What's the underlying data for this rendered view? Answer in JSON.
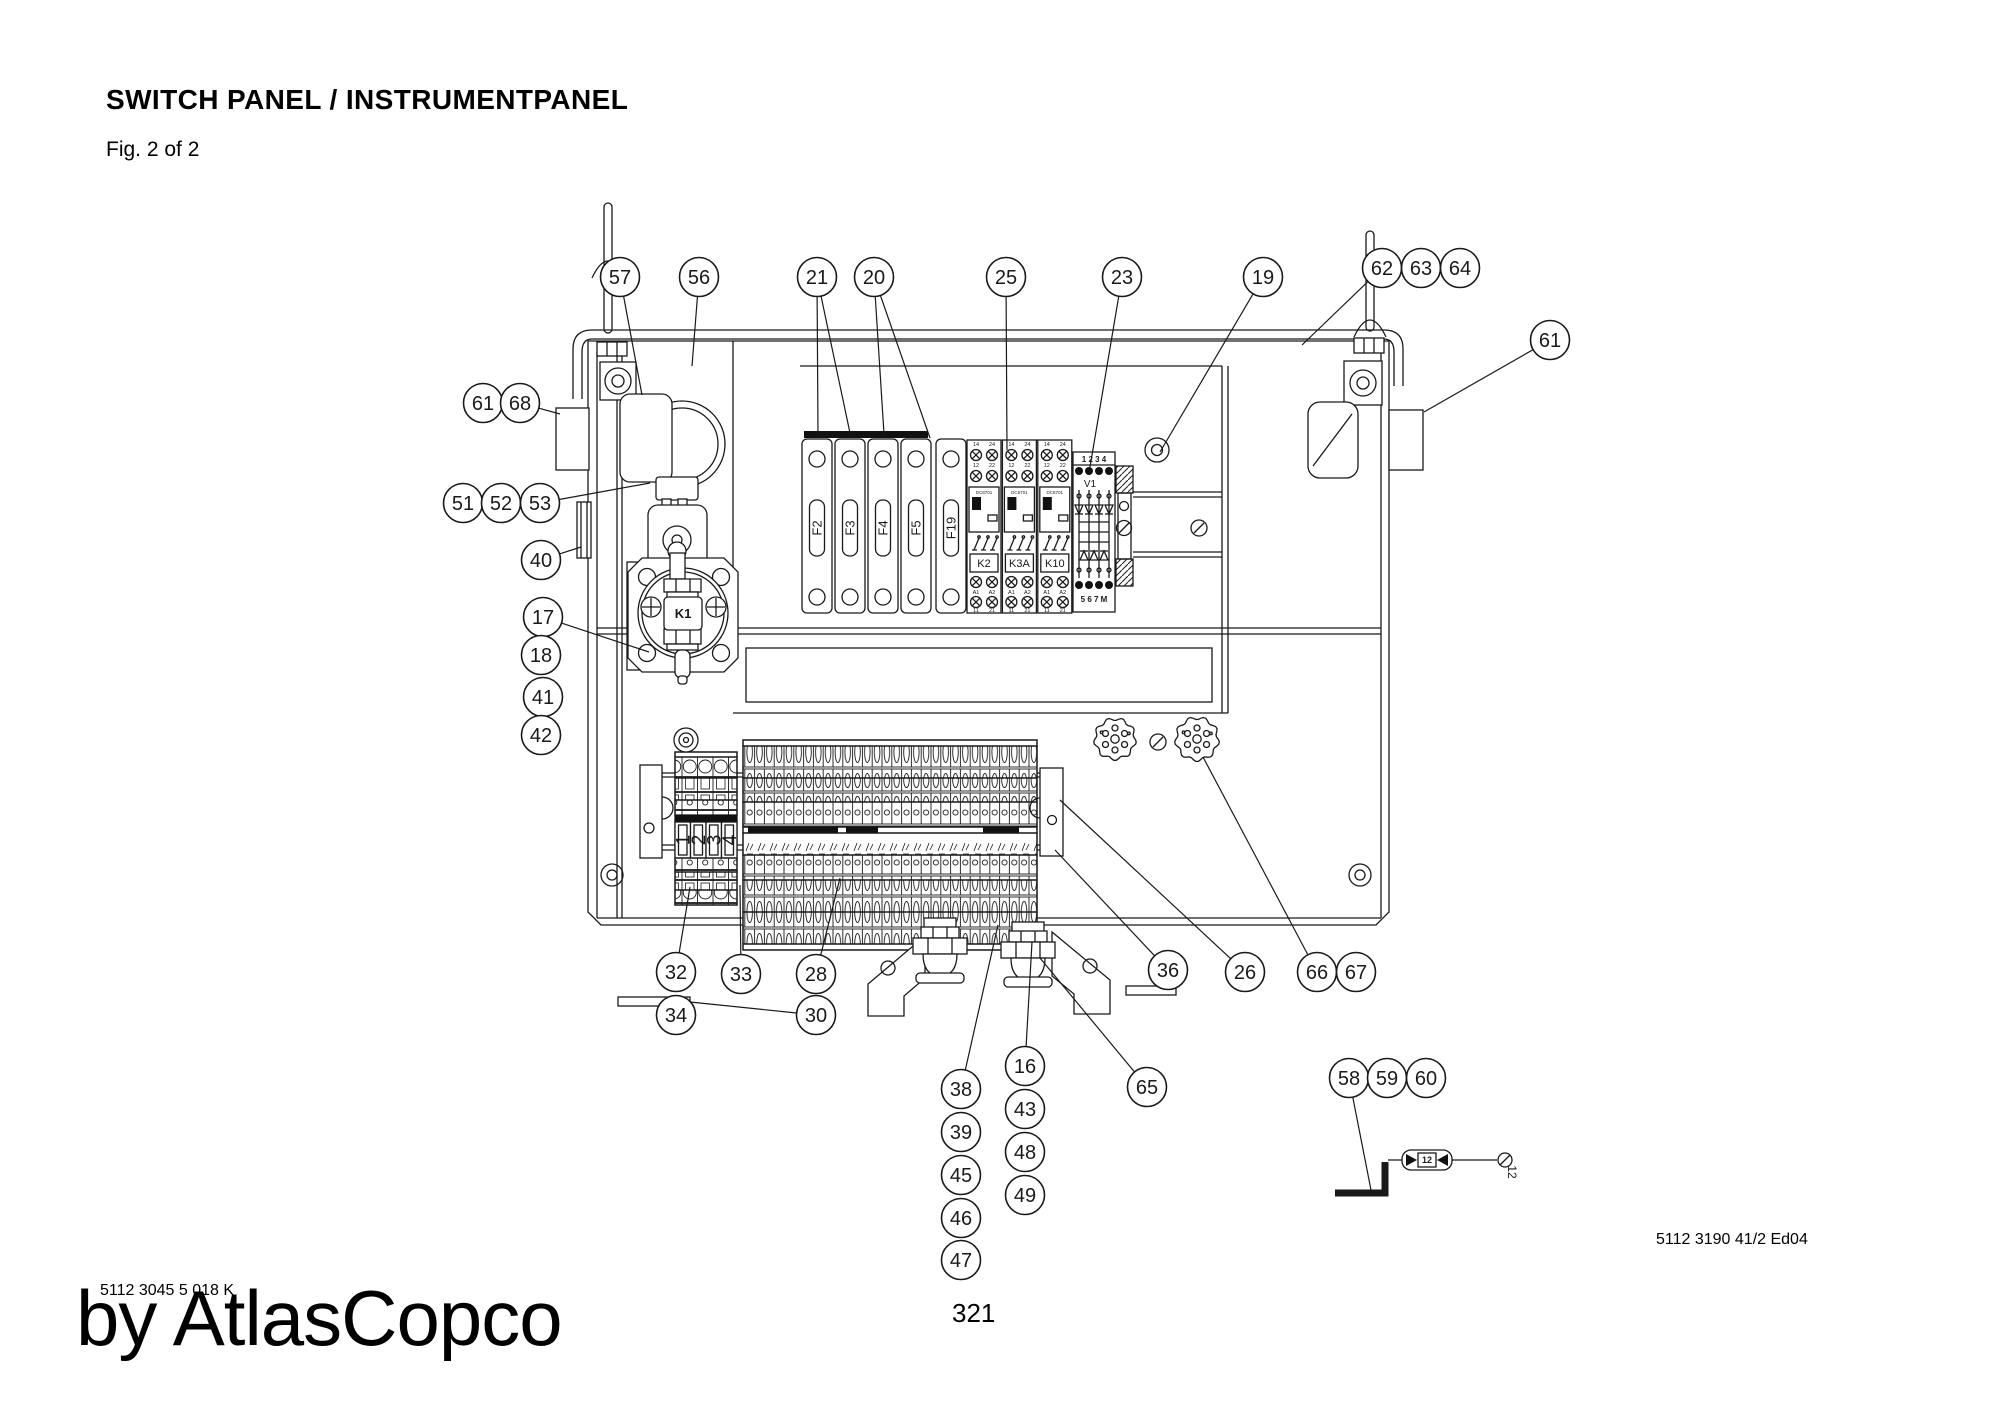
{
  "header": {
    "title": "SWITCH PANEL / INSTRUMENTPANEL",
    "figure": "Fig. 2 of 2"
  },
  "footer": {
    "page_number": "321",
    "doc_number_left": "5112 3045 5 018 K",
    "doc_number_right": "5112 3190 41/2 Ed04",
    "watermark": "by AtlasCopco"
  },
  "drawing": {
    "fuses": [
      "F2",
      "F3",
      "F4",
      "F5",
      "F19"
    ],
    "relays": [
      "K2",
      "K3A",
      "K10"
    ],
    "relay_code": "DC8701",
    "relay_terminals": {
      "row1": [
        "14",
        "24"
      ],
      "row2": [
        "12",
        "22"
      ],
      "row3": [
        "A1",
        "A2"
      ],
      "row4": [
        "11",
        "21"
      ]
    },
    "v1": {
      "label": "V1",
      "top": "1 2 3 4",
      "bottom": "5 6 7 M"
    },
    "k1_label": "K1",
    "terminal_block_numbers": [
      "1",
      "2",
      "3",
      "4"
    ],
    "inline_fuse": {
      "label": "12",
      "wire_ref": "12"
    }
  },
  "callouts": [
    {
      "n": "57",
      "x": 620,
      "y": 277,
      "to": [
        [
          642,
          395
        ]
      ]
    },
    {
      "n": "56",
      "x": 699,
      "y": 277,
      "to": [
        [
          692,
          366
        ]
      ]
    },
    {
      "n": "21",
      "x": 817,
      "y": 277,
      "to": [
        [
          818,
          433
        ],
        [
          850,
          433
        ]
      ]
    },
    {
      "n": "20",
      "x": 874,
      "y": 277,
      "to": [
        [
          884,
          434
        ],
        [
          930,
          438
        ]
      ]
    },
    {
      "n": "25",
      "x": 1006,
      "y": 277,
      "to": [
        [
          1007,
          450
        ]
      ]
    },
    {
      "n": "23",
      "x": 1122,
      "y": 277,
      "to": [
        [
          1090,
          467
        ]
      ]
    },
    {
      "n": "19",
      "x": 1263,
      "y": 277,
      "to": [
        [
          1160,
          452
        ]
      ]
    },
    {
      "n": "62",
      "x": 1382,
      "y": 268,
      "to": [
        [
          1302,
          345
        ]
      ]
    },
    {
      "n": "63",
      "x": 1421,
      "y": 268,
      "to": []
    },
    {
      "n": "64",
      "x": 1460,
      "y": 268,
      "to": []
    },
    {
      "n": "61",
      "x": 1550,
      "y": 340,
      "to": [
        [
          1424,
          412
        ]
      ]
    },
    {
      "n": "61",
      "x": 483,
      "y": 403,
      "to": []
    },
    {
      "n": "68",
      "x": 520,
      "y": 403,
      "to": [
        [
          560,
          414
        ]
      ]
    },
    {
      "n": "51",
      "x": 463,
      "y": 503,
      "to": []
    },
    {
      "n": "52",
      "x": 501,
      "y": 503,
      "to": []
    },
    {
      "n": "53",
      "x": 540,
      "y": 503,
      "to": [
        [
          650,
          483
        ]
      ]
    },
    {
      "n": "40",
      "x": 541,
      "y": 560,
      "to": [
        [
          581,
          547
        ]
      ]
    },
    {
      "n": "17",
      "x": 543,
      "y": 617,
      "to": [
        [
          649,
          652
        ]
      ]
    },
    {
      "n": "18",
      "x": 541,
      "y": 655,
      "to": []
    },
    {
      "n": "41",
      "x": 543,
      "y": 697,
      "to": []
    },
    {
      "n": "42",
      "x": 541,
      "y": 735,
      "to": []
    },
    {
      "n": "32",
      "x": 676,
      "y": 972,
      "to": [
        [
          690,
          887
        ]
      ]
    },
    {
      "n": "34",
      "x": 676,
      "y": 1015,
      "to": []
    },
    {
      "n": "33",
      "x": 741,
      "y": 974,
      "to": [
        [
          740,
          885
        ]
      ]
    },
    {
      "n": "28",
      "x": 816,
      "y": 974,
      "to": [
        [
          840,
          878
        ]
      ]
    },
    {
      "n": "30",
      "x": 816,
      "y": 1015,
      "to": [
        [
          690,
          1002
        ]
      ]
    },
    {
      "n": "36",
      "x": 1168,
      "y": 970,
      "to": [
        [
          1055,
          850
        ]
      ]
    },
    {
      "n": "26",
      "x": 1245,
      "y": 972,
      "to": [
        [
          1060,
          800
        ]
      ]
    },
    {
      "n": "66",
      "x": 1317,
      "y": 972,
      "to": [
        [
          1203,
          757
        ]
      ]
    },
    {
      "n": "67",
      "x": 1356,
      "y": 972,
      "to": []
    },
    {
      "n": "38",
      "x": 961,
      "y": 1089,
      "to": [
        [
          998,
          925
        ]
      ]
    },
    {
      "n": "39",
      "x": 961,
      "y": 1132,
      "to": []
    },
    {
      "n": "45",
      "x": 961,
      "y": 1175,
      "to": []
    },
    {
      "n": "46",
      "x": 961,
      "y": 1218,
      "to": []
    },
    {
      "n": "47",
      "x": 961,
      "y": 1260,
      "to": []
    },
    {
      "n": "16",
      "x": 1025,
      "y": 1066,
      "to": [
        [
          1032,
          942
        ]
      ]
    },
    {
      "n": "43",
      "x": 1025,
      "y": 1109,
      "to": []
    },
    {
      "n": "48",
      "x": 1025,
      "y": 1152,
      "to": []
    },
    {
      "n": "49",
      "x": 1025,
      "y": 1195,
      "to": []
    },
    {
      "n": "65",
      "x": 1147,
      "y": 1087,
      "to": [
        [
          1040,
          958
        ]
      ]
    },
    {
      "n": "58",
      "x": 1349,
      "y": 1078,
      "to": [
        [
          1371,
          1190
        ]
      ]
    },
    {
      "n": "59",
      "x": 1387,
      "y": 1078,
      "to": []
    },
    {
      "n": "60",
      "x": 1426,
      "y": 1078,
      "to": []
    }
  ]
}
